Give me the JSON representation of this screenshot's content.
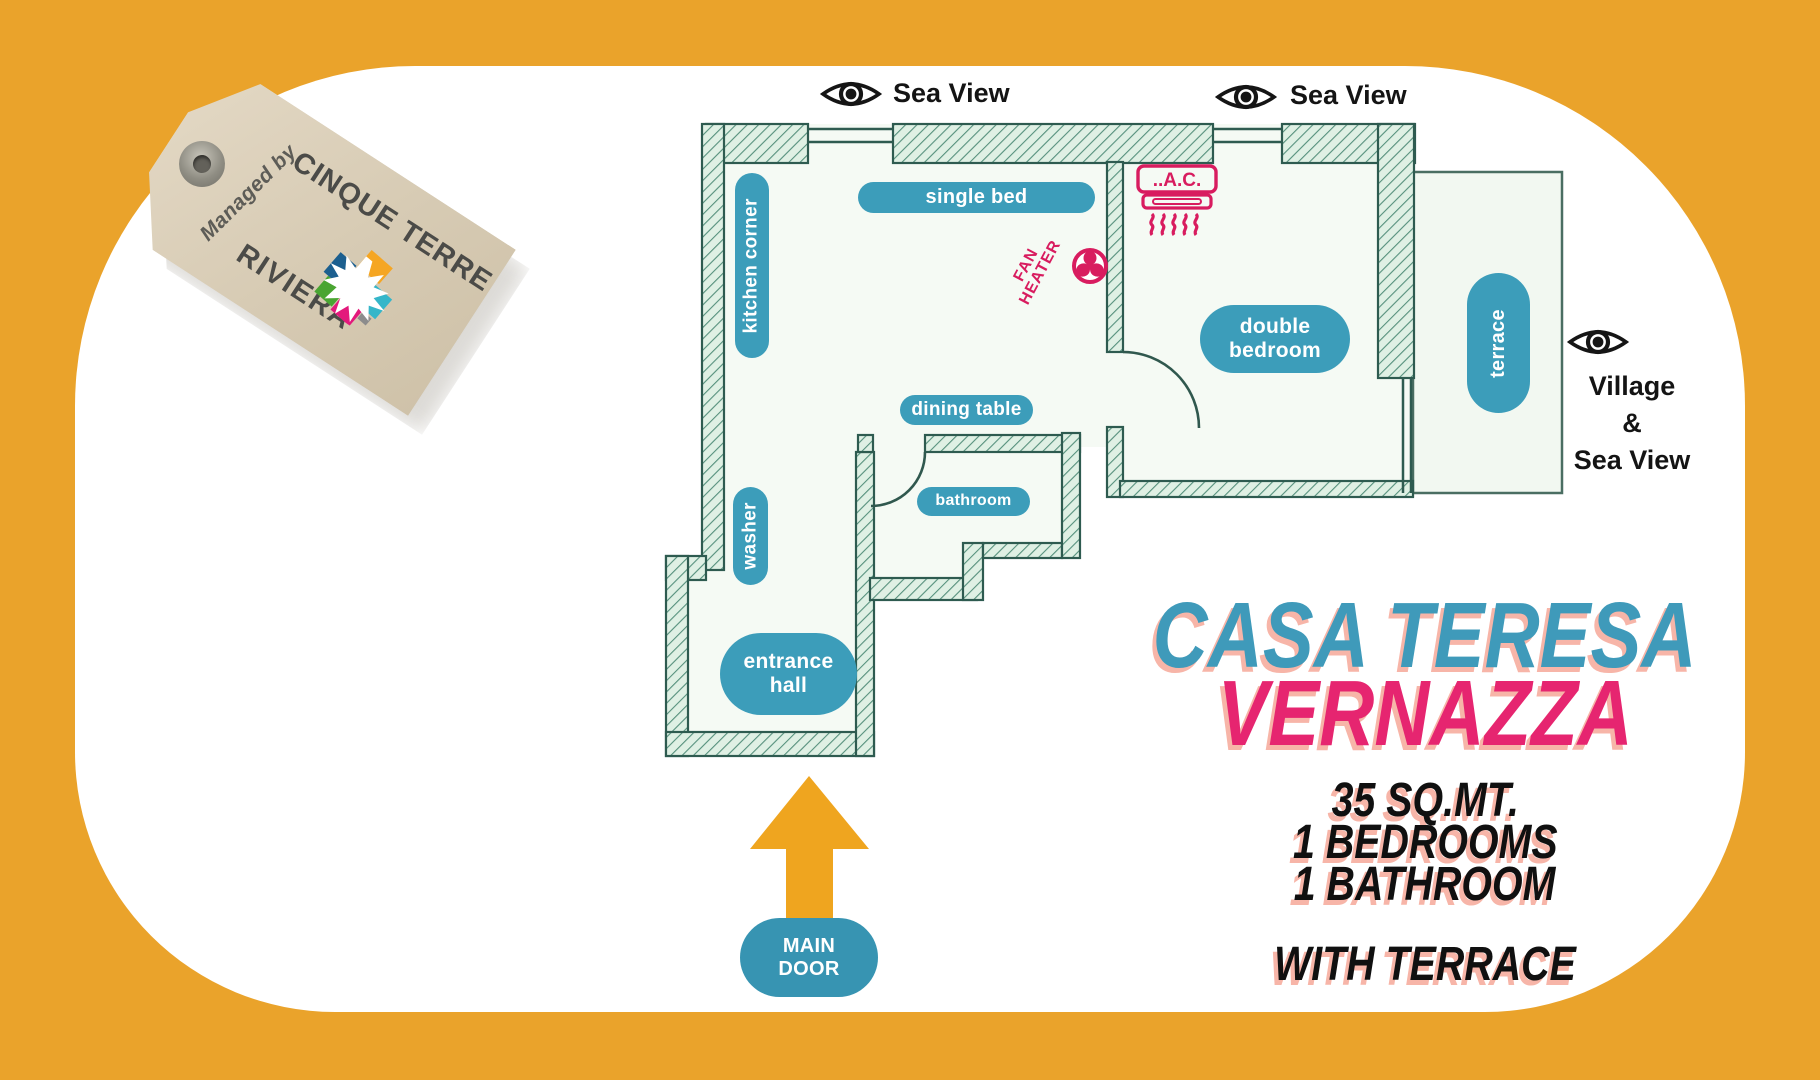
{
  "header": {
    "sea_view_left": "Sea View",
    "sea_view_right": "Sea View"
  },
  "side_view": {
    "line1": "Village",
    "line2": "&",
    "line3": "Sea View"
  },
  "tag": {
    "managed_by": "Managed by",
    "brand_top": "CINQUE TERRE",
    "brand_bottom": "RIVIERA"
  },
  "rooms": {
    "kitchen": "kitchen corner",
    "washer": "washer",
    "entrance_line1": "entrance",
    "entrance_line2": "hall",
    "dining": "dining table",
    "bathroom": "bathroom",
    "single_bed": "single bed",
    "double_line1": "double",
    "double_line2": "bedroom",
    "terrace": "terrace"
  },
  "features": {
    "ac": "..A.C.",
    "fan_line1": "FAN",
    "fan_line2": "HEATER"
  },
  "main_door": {
    "line1": "MAIN",
    "line2": "DOOR"
  },
  "listing": {
    "title": "CASA TERESA",
    "location": "VERNAZZA",
    "area": "35 SQ.MT.",
    "bedrooms": "1 BEDROOMS",
    "bathroom": "1 BATHROOM",
    "extra": "WITH TERRACE"
  },
  "colors": {
    "background": "#EAA32B",
    "pill_teal": "#3C9DBA",
    "title_teal": "#3F9ABA",
    "location_pink": "#E62570",
    "feature_crimson": "#D81C5F",
    "wall_green": "#2E5B50",
    "shadow_salmon": "#F7B5A8"
  }
}
